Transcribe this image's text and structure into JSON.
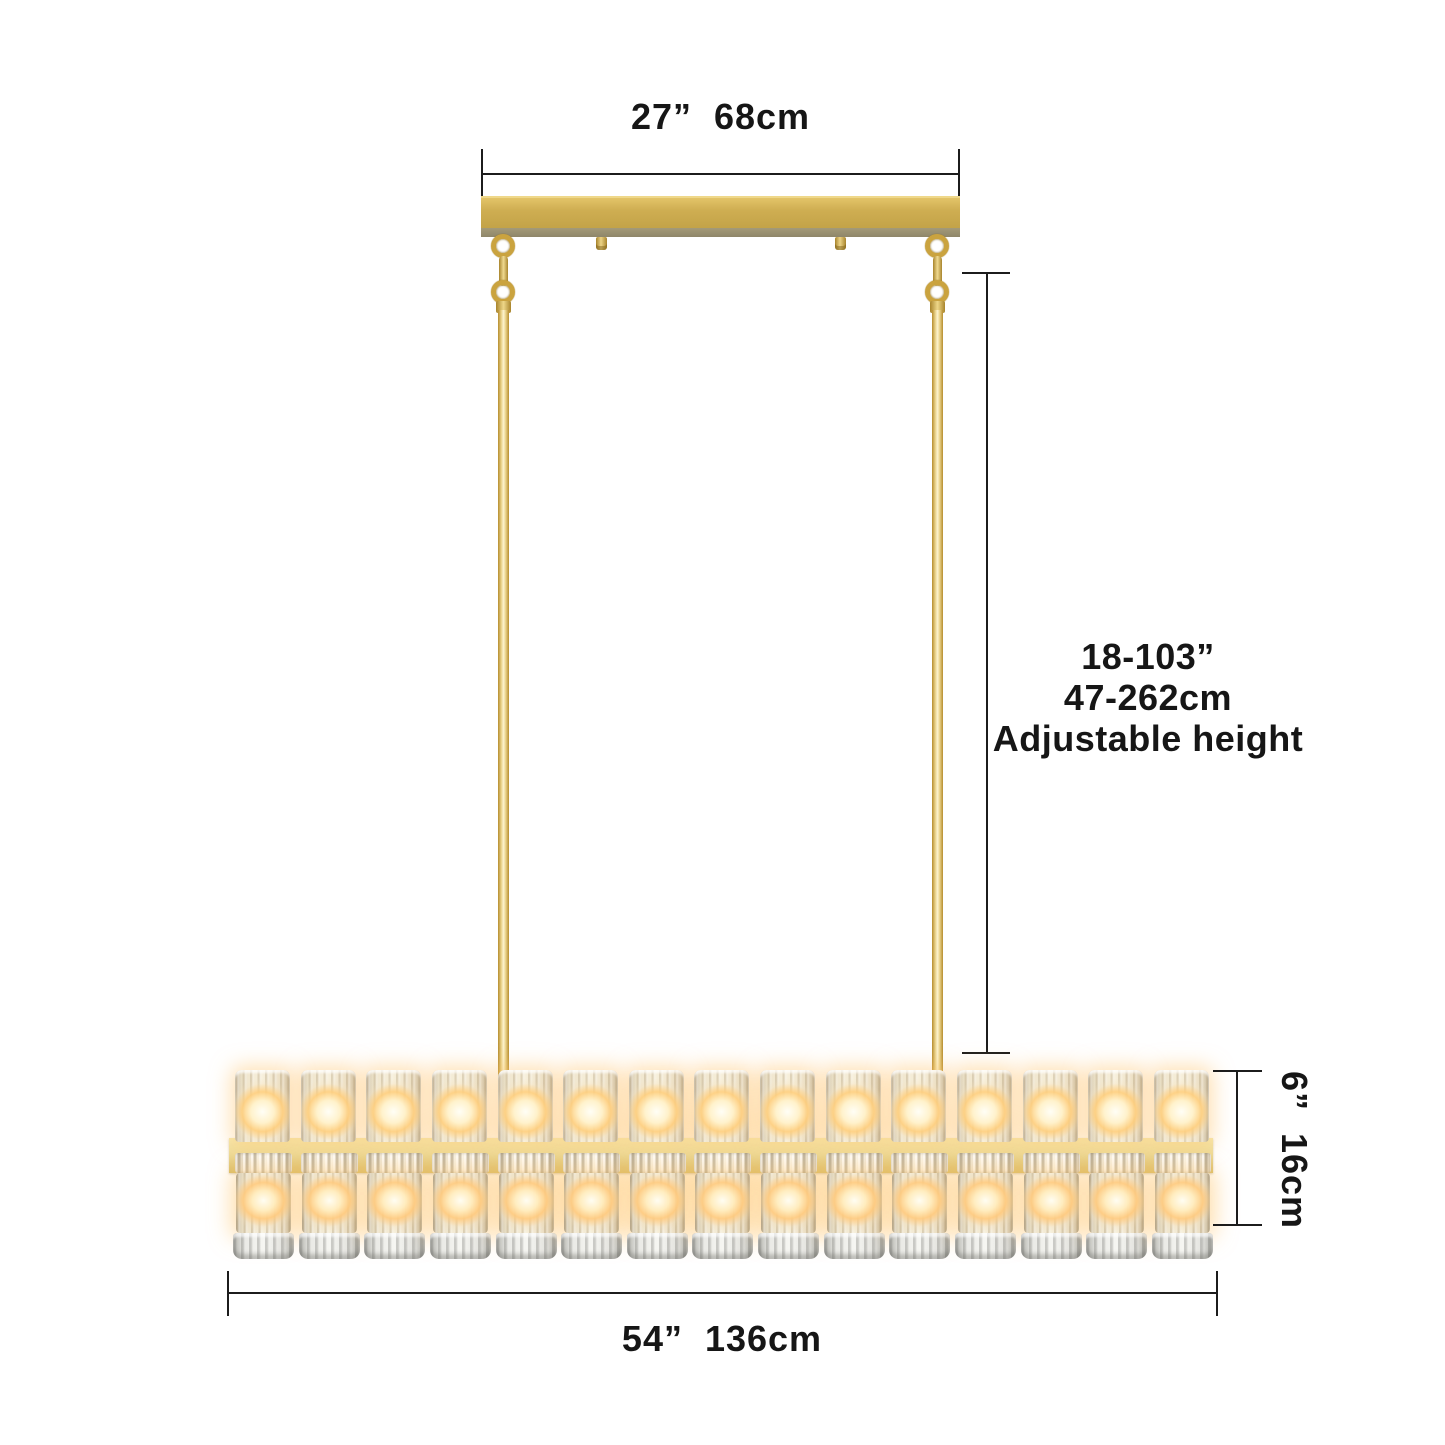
{
  "labels": {
    "canopy_width": "27”  68cm",
    "height_range_in": "18-103”",
    "height_range_cm": "47-262cm",
    "height_note": "Adjustable height",
    "fixture_height": "6”  16cm",
    "fixture_width": "54”  136cm"
  },
  "lights": {
    "top_count": 15,
    "bottom_count": 15,
    "total": 30
  },
  "colors": {
    "background": "#ffffff",
    "dimension_line": "#1c1c1c",
    "gold_canopy": "#cfae52",
    "gold_canopy_underside": "#a39a78",
    "gold_bar_highlight": "#f6e9b0",
    "gold_bar_shadow": "#d9bd69",
    "gold_rod_edge": "#b68d2e",
    "gold_rod_highlight": "#fdf4cf",
    "glow": "#ffc46a",
    "crystal": "#f2e9d5"
  }
}
